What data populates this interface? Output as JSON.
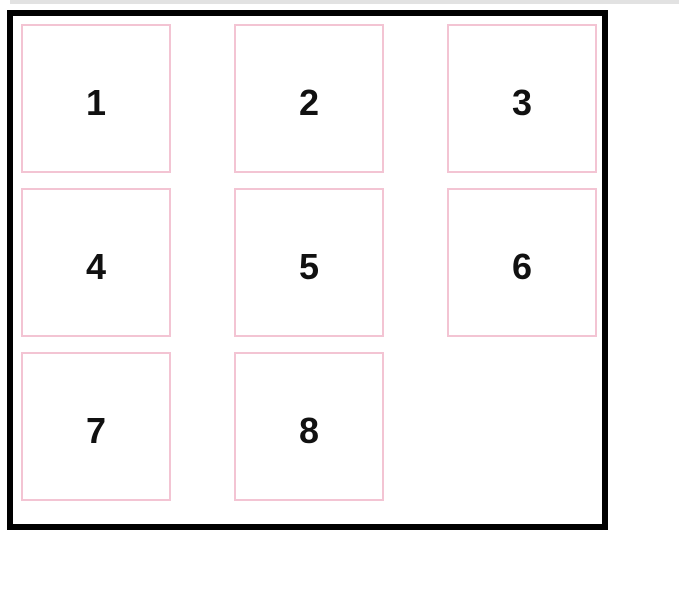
{
  "window": {
    "top_edge_strip_color": "#e2e2e2"
  },
  "grid": {
    "items": [
      "1",
      "2",
      "3",
      "4",
      "5",
      "6",
      "7",
      "8"
    ],
    "empty_cells": 1,
    "colors": {
      "container_border": "#000000",
      "item_border": "#f3c4d3",
      "item_background": "#ffffff",
      "digit_color": "#111111",
      "page_background": "#ffffff"
    }
  }
}
